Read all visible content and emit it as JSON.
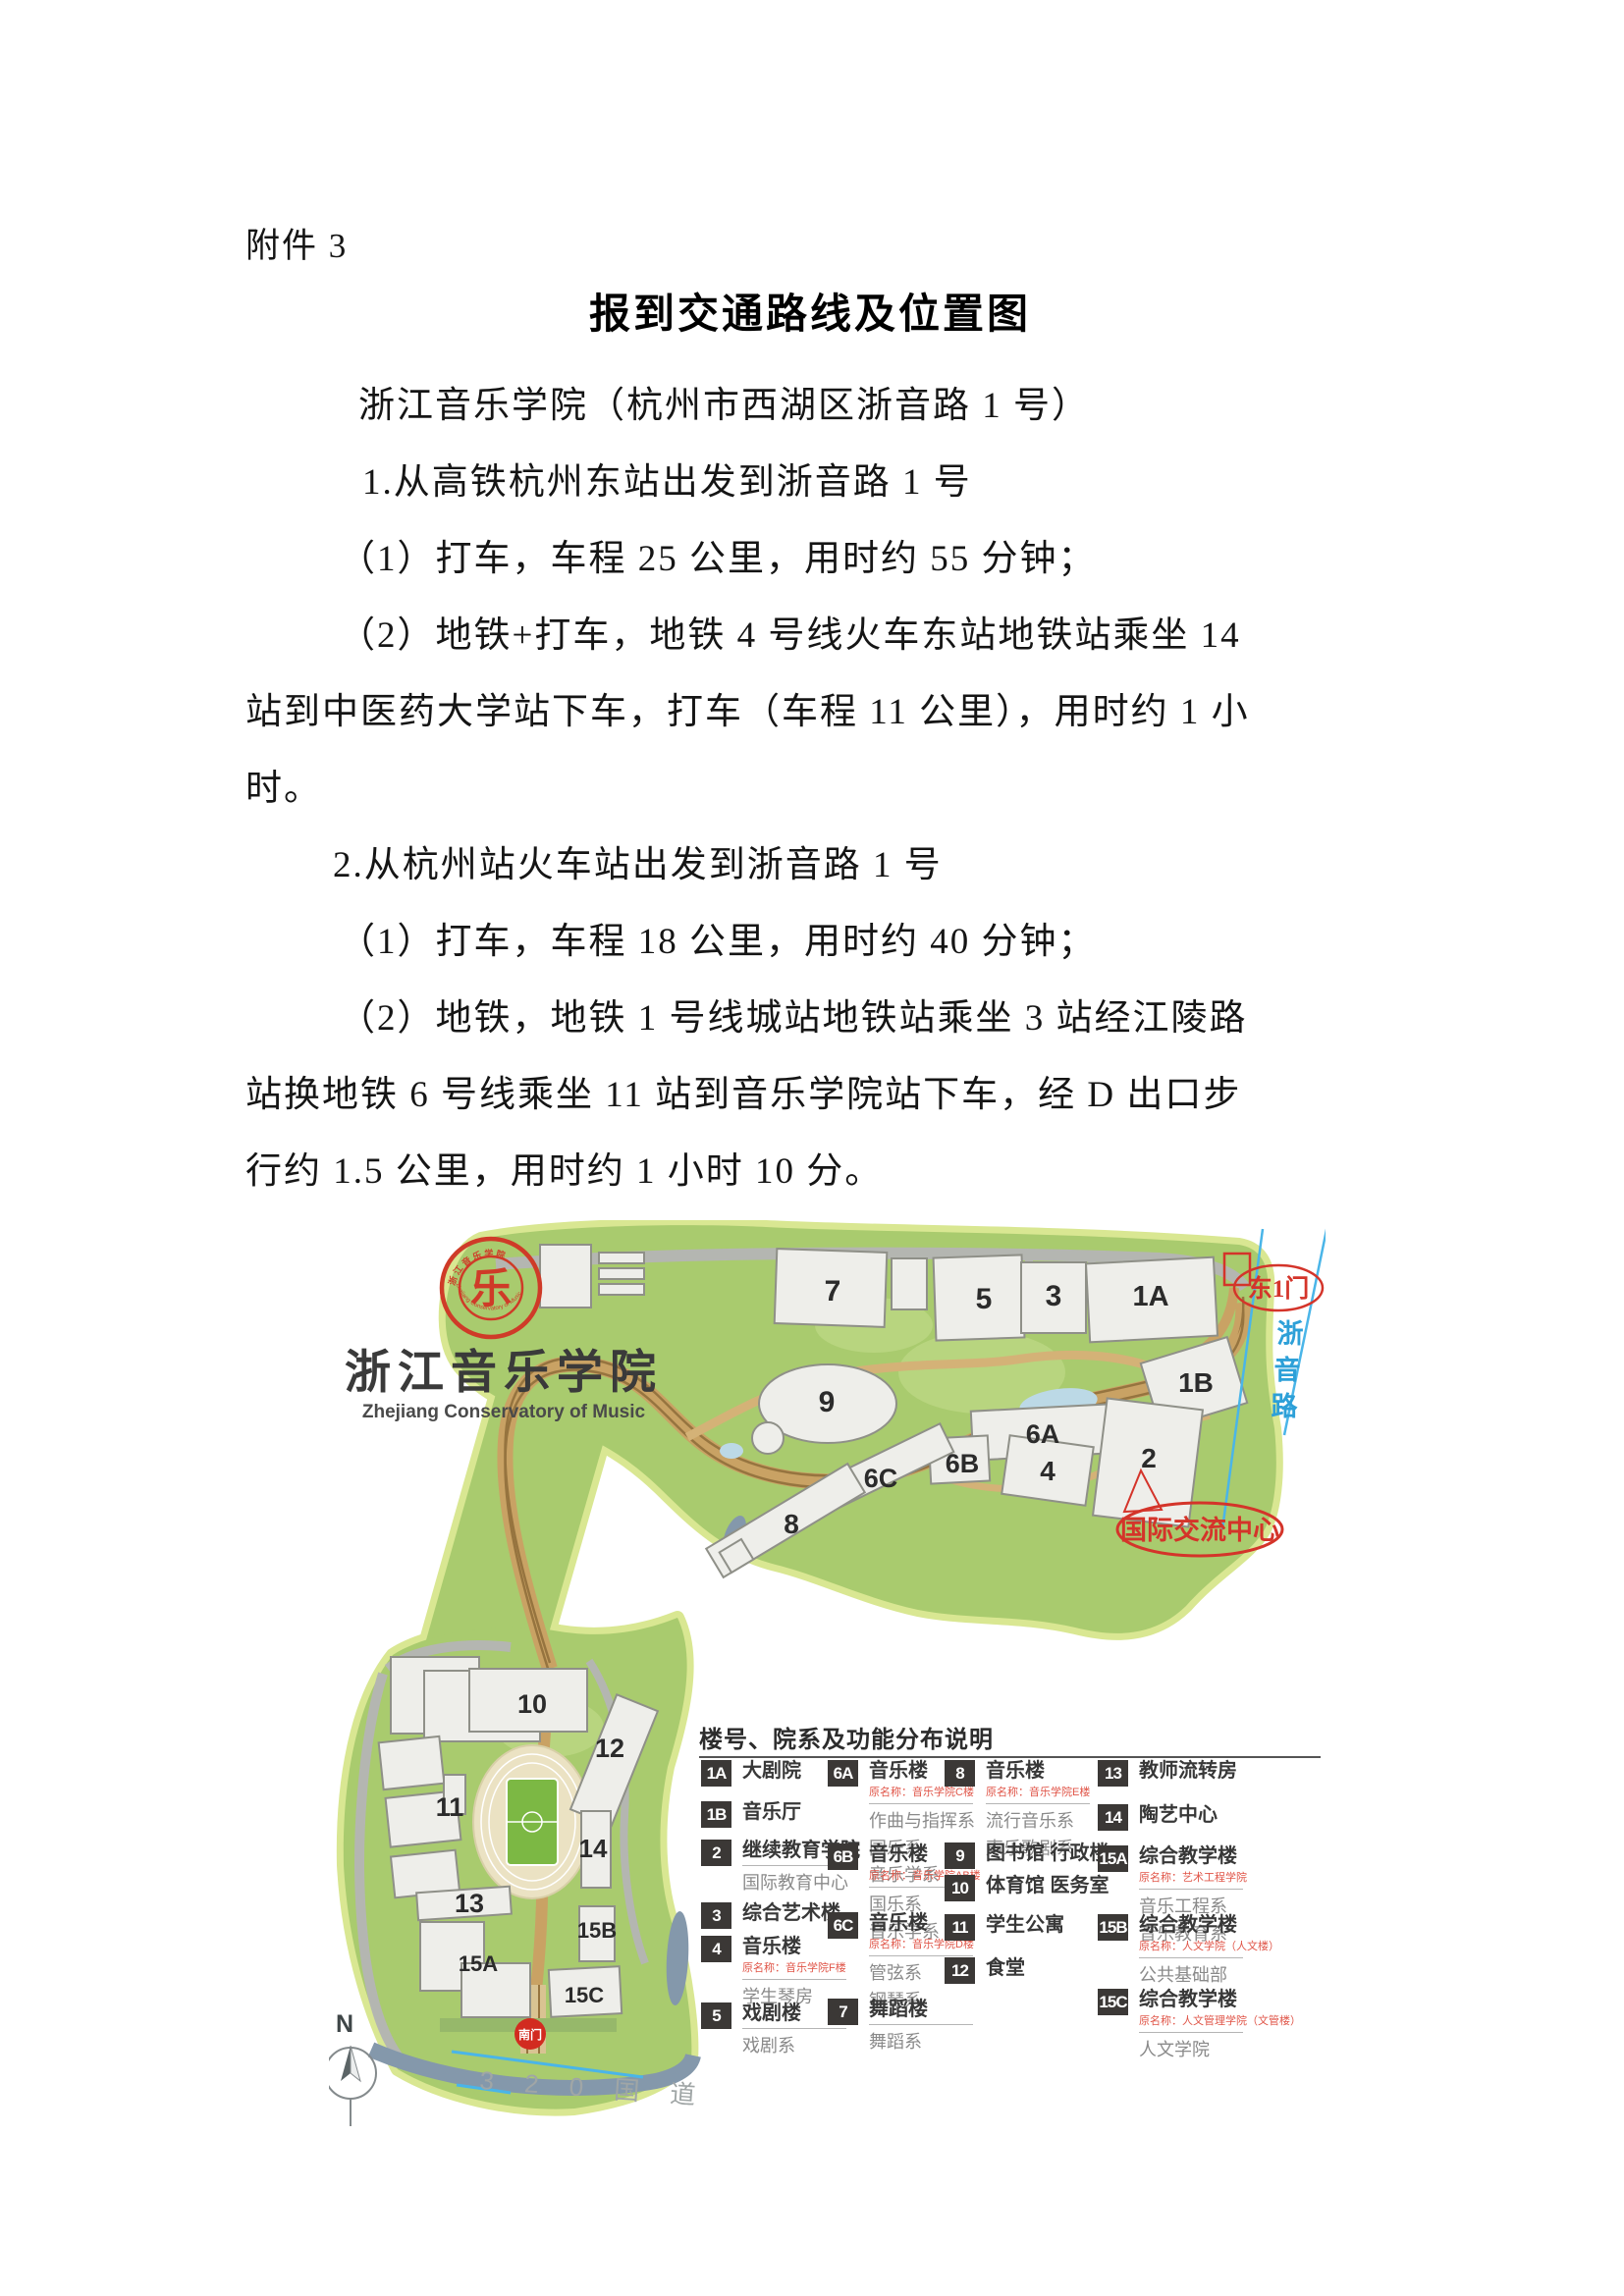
{
  "doc": {
    "attachment_label": "附件 3",
    "title": "报到交通路线及位置图",
    "lines": [
      {
        "text": "浙江音乐学院（杭州市西湖区浙音路 1 号）"
      },
      {
        "text": "1.从高铁杭州东站出发到浙音路 1 号"
      },
      {
        "text": "（1）打车，车程 25 公里，用时约 55 分钟；"
      },
      {
        "text": "（2）地铁+打车，地铁 4 号线火车东站地铁站乘坐 14"
      },
      {
        "text": "站到中医药大学站下车，打车（车程 11 公里），用时约 1 小"
      },
      {
        "text": "时。"
      },
      {
        "text": "2.从杭州站火车站出发到浙音路 1 号"
      },
      {
        "text": "（1）打车，车程 18 公里，用时约 40 分钟；"
      },
      {
        "text": "（2）地铁，地铁 1 号线城站地铁站乘坐 3 站经江陵路"
      },
      {
        "text": "站换地铁 6 号线乘坐 11 站到音乐学院站下车，经 D 出口步"
      },
      {
        "text": "行约 1.5 公里，用时约 1 小时 10 分。"
      }
    ]
  },
  "logo": {
    "seal_glyph": "乐",
    "seal_arc_cn": "浙 江 音 乐 学 院",
    "seal_arc_en": "Zhejiang Conservatory of Music",
    "name_cn": "浙江音乐学院",
    "name_en": "Zhejiang Conservatory of Music",
    "seal_color": "#cf3b28"
  },
  "map": {
    "buildings": [
      {
        "label": "7"
      },
      {
        "label": "5"
      },
      {
        "label": "3"
      },
      {
        "label": "1A"
      },
      {
        "label": "9"
      },
      {
        "label": "1B"
      },
      {
        "label": "6A"
      },
      {
        "label": "6B"
      },
      {
        "label": "6C"
      },
      {
        "label": "4"
      },
      {
        "label": "2"
      },
      {
        "label": "8"
      },
      {
        "label": "10"
      },
      {
        "label": "12"
      },
      {
        "label": "11"
      },
      {
        "label": "14"
      },
      {
        "label": "13"
      },
      {
        "label": "15A"
      },
      {
        "label": "15B"
      },
      {
        "label": "15C"
      }
    ],
    "east_gate": "东1门",
    "road_chars": [
      "浙",
      "音",
      "路"
    ],
    "intl_center": "国际交流中心",
    "south_gate": "南门",
    "national_road": "3 2 0  国 道",
    "north_label": "N",
    "colors": {
      "campus_green": "#a9cb6e",
      "campus_edge": "#d9e792",
      "road_gray": "#b4b6b1",
      "path_tan": "#c9a264",
      "water": "#8498ab",
      "annotation_red": "#d4342a",
      "road_text_blue": "#2da0d8"
    }
  },
  "legend": {
    "title": "楼号、院系及功能分布说明",
    "entries": [
      {
        "id": "1A",
        "name": "大剧院"
      },
      {
        "id": "1B",
        "name": "音乐厅"
      },
      {
        "id": "2",
        "name": "继续教育学院",
        "subs": [
          "国际教育中心"
        ]
      },
      {
        "id": "3",
        "name": "综合艺术楼"
      },
      {
        "id": "4",
        "name": "音乐楼",
        "orig": "原名称：音乐学院F楼",
        "subs": [
          "学生琴房"
        ]
      },
      {
        "id": "5",
        "name": "戏剧楼",
        "subs": [
          "戏剧系"
        ]
      },
      {
        "id": "6A",
        "name": "音乐楼",
        "orig": "原名称：音乐学院C楼",
        "subs": [
          "作曲与指挥系",
          "国乐系",
          "音乐学系"
        ]
      },
      {
        "id": "6B",
        "name": "音乐楼",
        "orig": "原名称：音乐学院AB楼",
        "subs": [
          "国乐系",
          "音乐学系"
        ]
      },
      {
        "id": "6C",
        "name": "音乐楼",
        "orig": "原名称：音乐学院D楼",
        "subs": [
          "管弦系",
          "钢琴系"
        ]
      },
      {
        "id": "7",
        "name": "舞蹈楼",
        "subs": [
          "舞蹈系"
        ]
      },
      {
        "id": "8",
        "name": "音乐楼",
        "orig": "原名称：音乐学院E楼",
        "subs": [
          "流行音乐系",
          "声乐歌剧系"
        ]
      },
      {
        "id": "9",
        "name": "图书馆 行政楼"
      },
      {
        "id": "10",
        "name": "体育馆 医务室"
      },
      {
        "id": "11",
        "name": "学生公寓"
      },
      {
        "id": "12",
        "name": "食堂"
      },
      {
        "id": "13",
        "name": "教师流转房"
      },
      {
        "id": "14",
        "name": "陶艺中心"
      },
      {
        "id": "15A",
        "name": "综合教学楼",
        "orig": "原名称：艺术工程学院",
        "subs": [
          "音乐工程系",
          "音乐教育系"
        ]
      },
      {
        "id": "15B",
        "name": "综合教学楼",
        "orig": "原名称：人文学院（人文楼）",
        "subs": [
          "公共基础部"
        ]
      },
      {
        "id": "15C",
        "name": "综合教学楼",
        "orig": "原名称：人文管理学院（文管楼）",
        "subs": [
          "人文学院"
        ]
      }
    ]
  }
}
